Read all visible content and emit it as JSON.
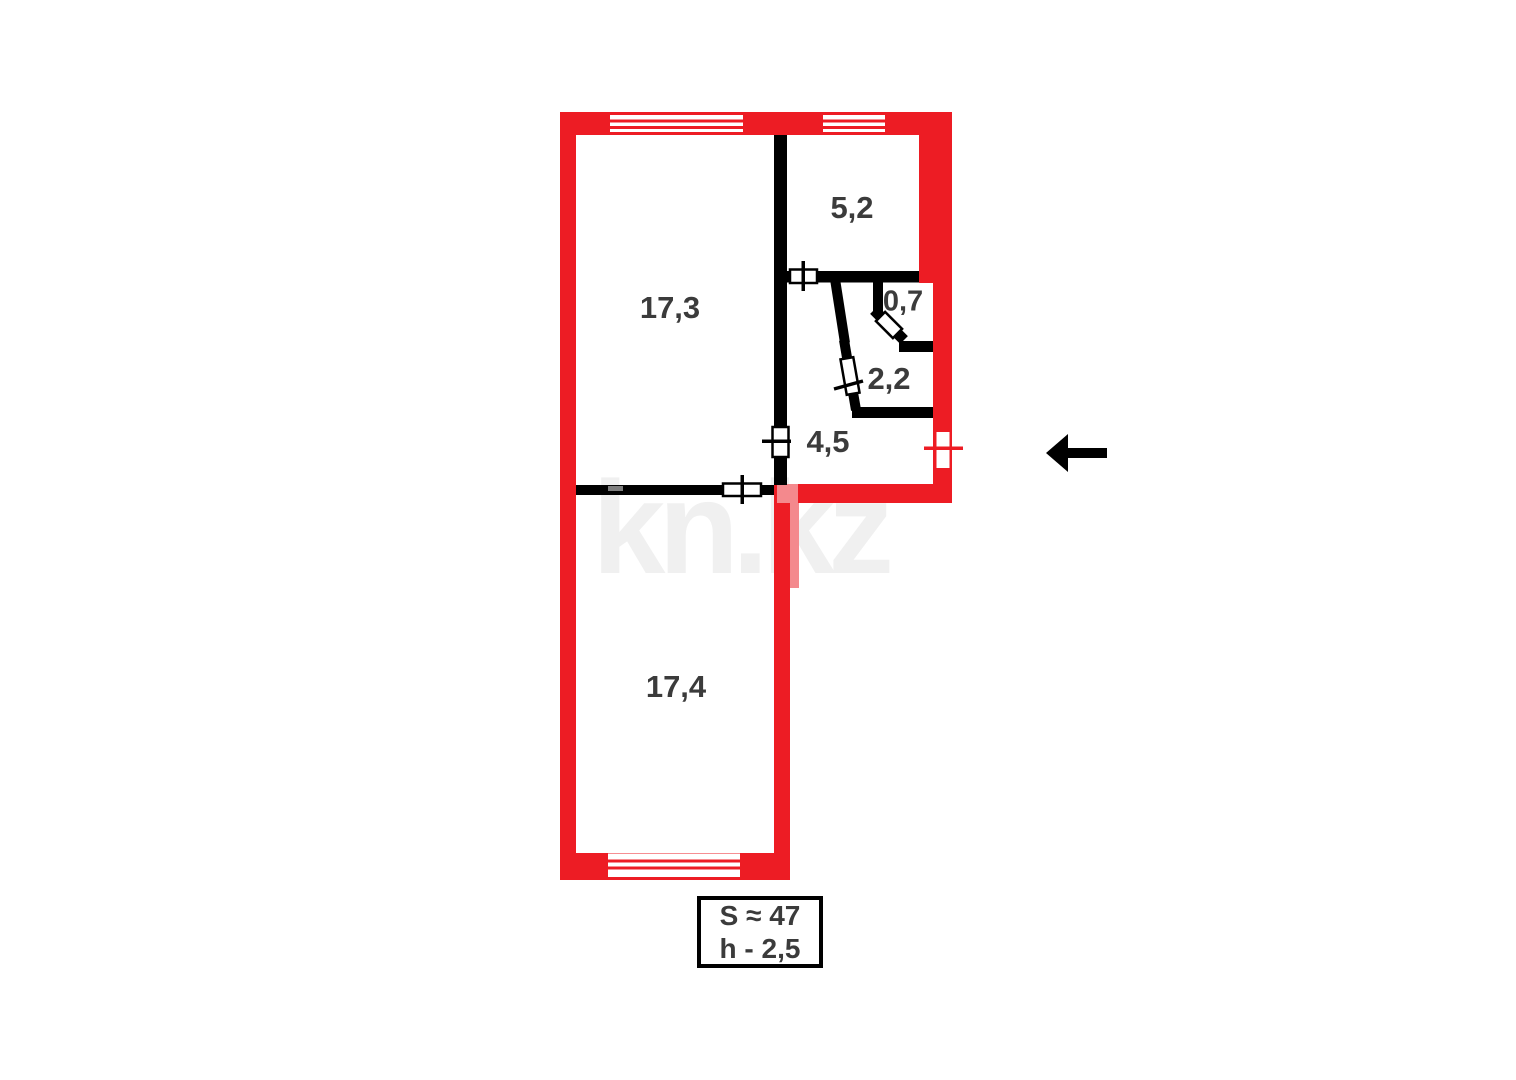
{
  "watermark": "kn.kz",
  "rooms": [
    {
      "area": "17,3"
    },
    {
      "area": "5,2"
    },
    {
      "area": "0,7"
    },
    {
      "area": "2,2"
    },
    {
      "area": "4,5"
    },
    {
      "area": "17,4"
    }
  ],
  "info_box": {
    "area_total": "S ≈ 47",
    "ceiling_height": "h - 2,5"
  },
  "colors": {
    "exterior_wall_red": "#ed1c24",
    "interior_wall_black": "#000000",
    "door_leaf_pink": "#f4898d",
    "room_label_gray": "#3b3b3b",
    "watermark_gray": "#f0f0f0",
    "vent_gray": "#7d7d7d"
  }
}
